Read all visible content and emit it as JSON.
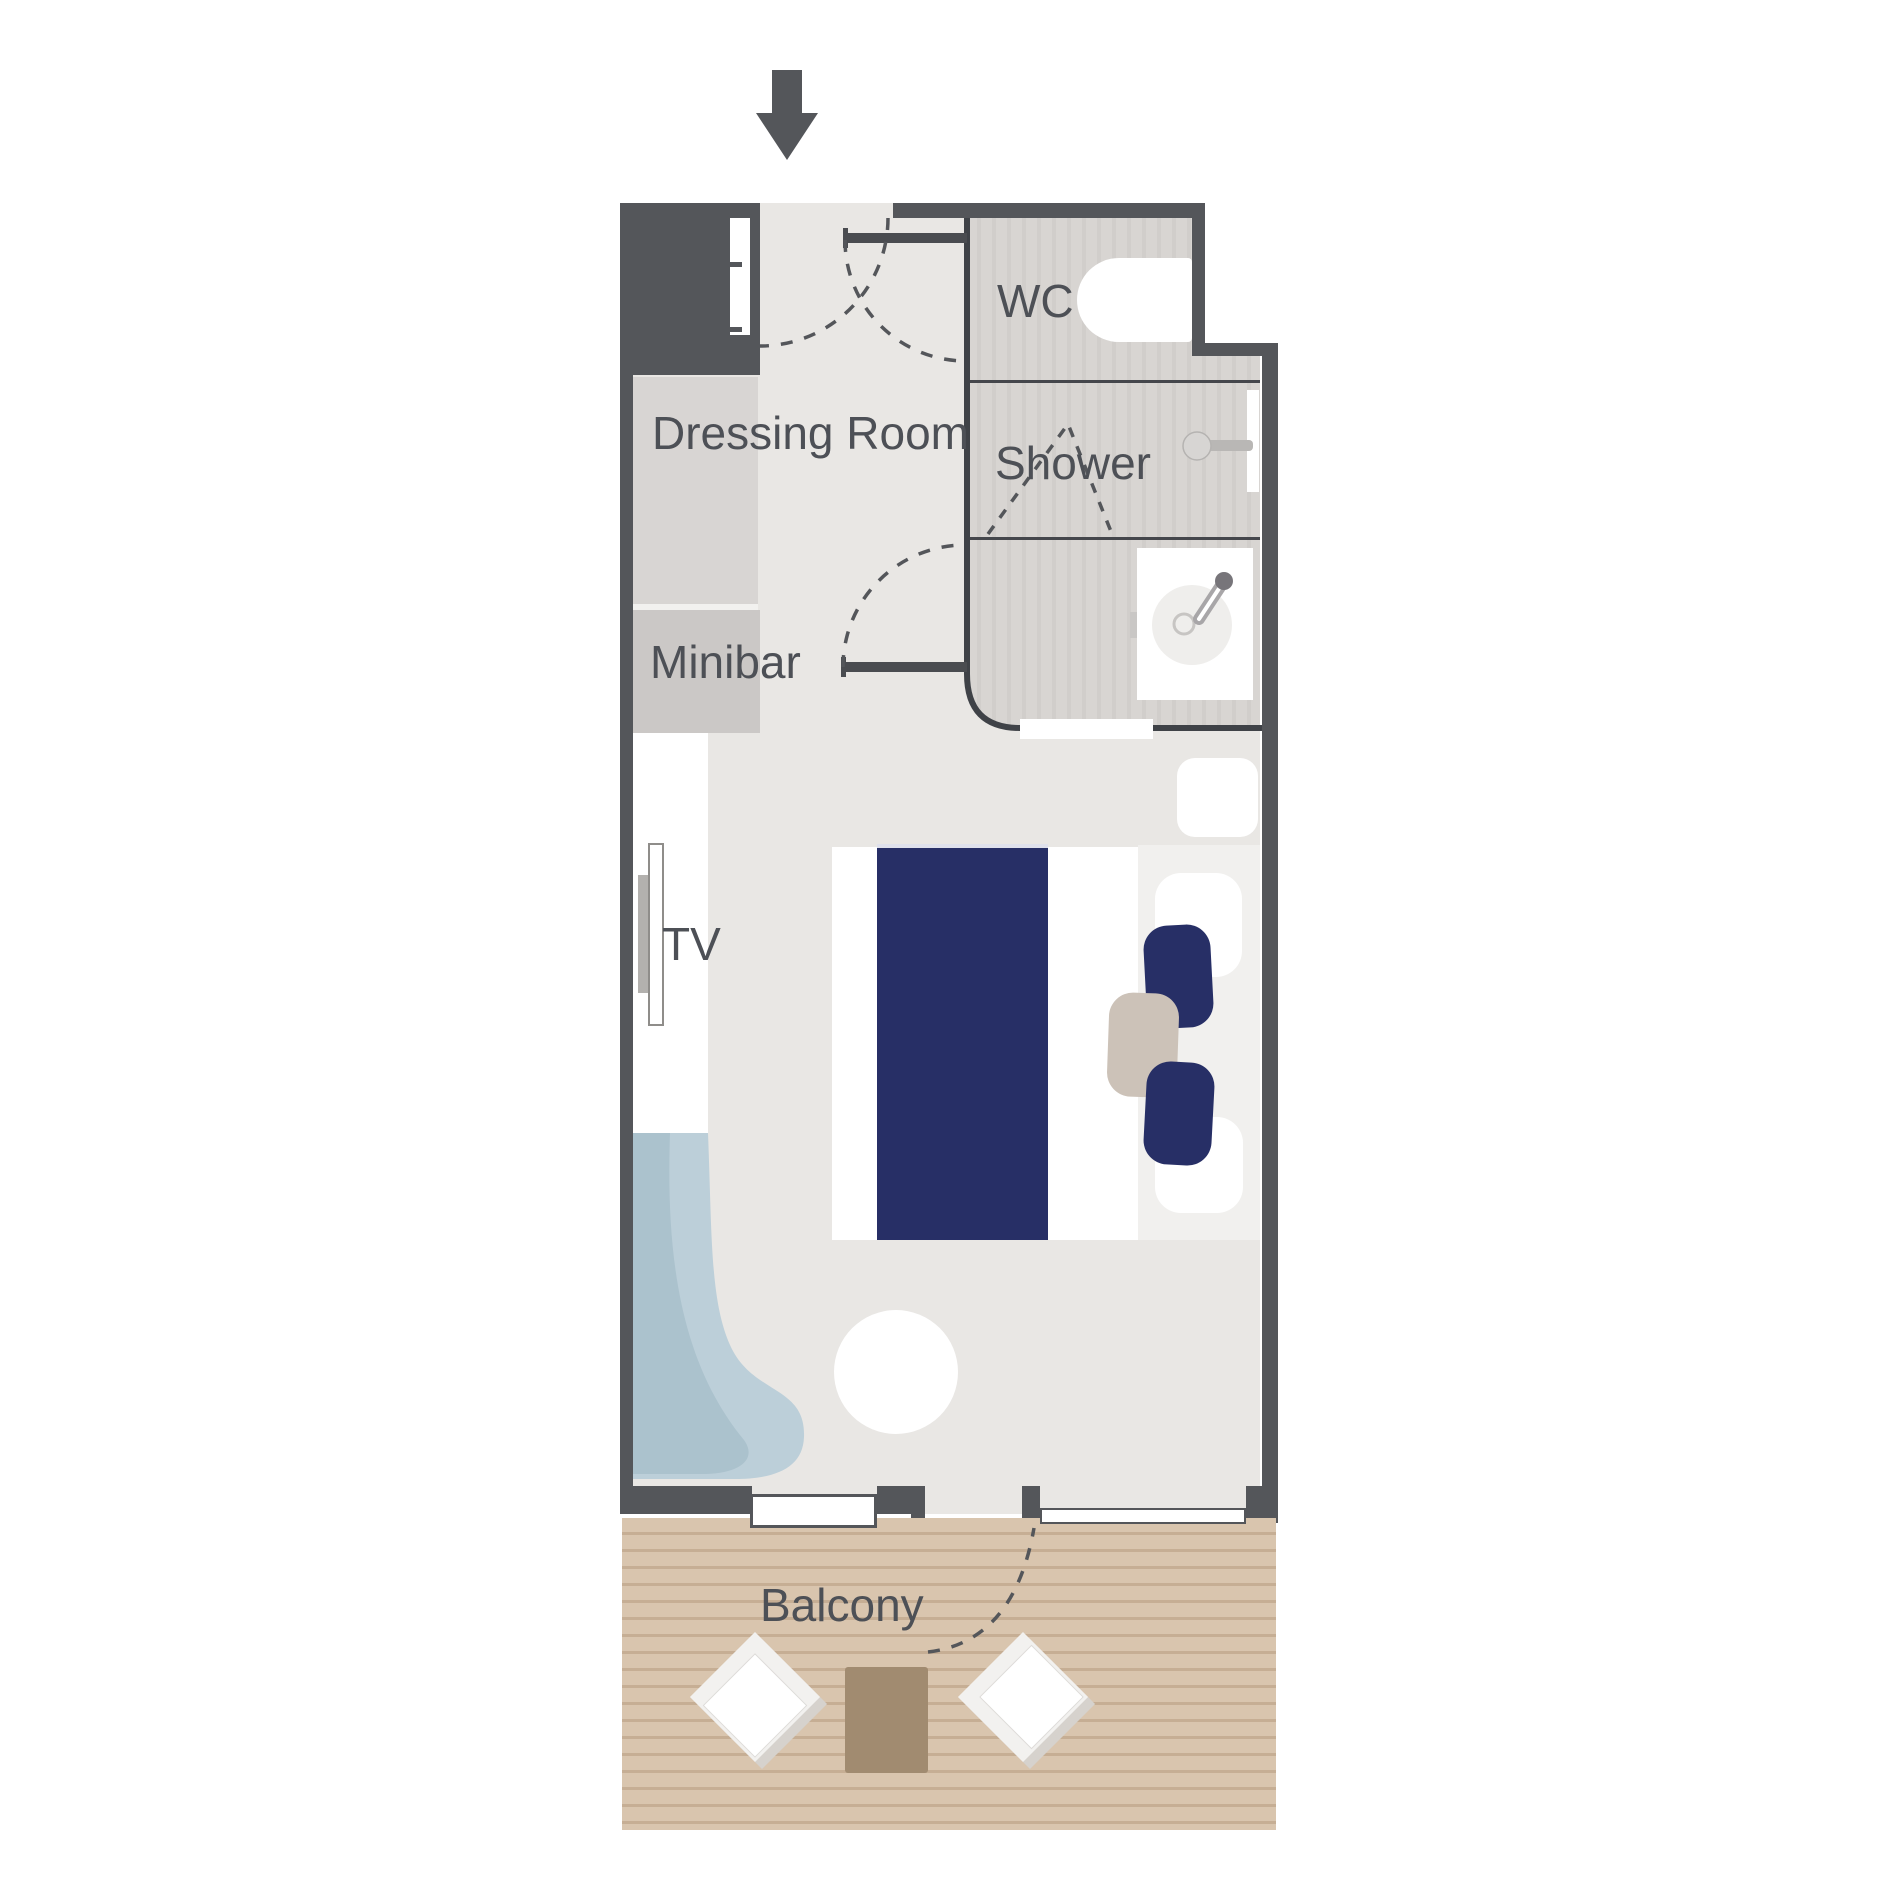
{
  "plan": {
    "type": "cabin-floor-plan",
    "entrance": "arrow-down",
    "labels": {
      "wc": "WC",
      "shower": "Shower",
      "dressing_room": "Dressing Room",
      "minibar": "Minibar",
      "tv": "TV",
      "balcony": "Balcony"
    },
    "rooms": [
      "Dressing Room",
      "WC",
      "Shower",
      "Bedroom",
      "Balcony"
    ],
    "furniture": [
      "wardrobe",
      "luggage-niche",
      "minibar",
      "desk",
      "tv",
      "double-bed",
      "nightstand",
      "armchair-top",
      "armchair-bottom",
      "side-table",
      "chaise",
      "round-table",
      "toilet",
      "shower-head",
      "washbasin",
      "balcony-chair-left",
      "balcony-chair-right",
      "balcony-table"
    ],
    "colors": {
      "wall": "#54565a",
      "floor": "#e9e7e4",
      "bathroom_floor": "#d8d5d2",
      "accent_navy": "#272f66",
      "chaise_blue": "#bccfd9",
      "deck": "#d9c5ae",
      "deck_line": "#c6ae94",
      "label_text": "#4d5056",
      "balcony_table_brown": "#a18b70",
      "side_table_beige": "#ccc2b8"
    }
  }
}
